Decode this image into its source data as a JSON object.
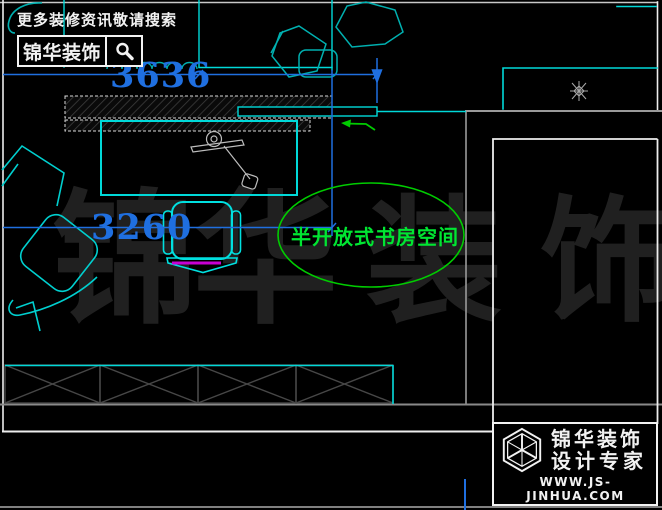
{
  "search_banner": {
    "tagline": "更多装修资讯敬请搜索",
    "brand": "锦华装饰"
  },
  "dimensions": {
    "top": "3636",
    "left": "3260"
  },
  "annotation": {
    "label": "半开放式书房空间"
  },
  "watermark": {
    "chars": [
      "锦",
      "华",
      "装",
      "饰"
    ]
  },
  "brand_card": {
    "brand_line1": "锦华装饰",
    "brand_line2": "设计专家",
    "website": "WWW.JS-JINHUA.COM"
  },
  "icons": {
    "search": "magnifier-icon",
    "logo": "cube-wireframe-icon",
    "star": "star-ornament-icon"
  },
  "colors": {
    "background": "#000000",
    "dimension_blue": "#1F6FE0",
    "line_cyan": "#00D9D9",
    "teal_decor": "#00B0B0",
    "ellipse_green": "#00CC00",
    "annotation_green": "#00E632",
    "magenta": "#C800D2",
    "wall_gray": "#9A9A9A",
    "wall_white": "#EDEDED",
    "watermark_gray": "#202020"
  }
}
